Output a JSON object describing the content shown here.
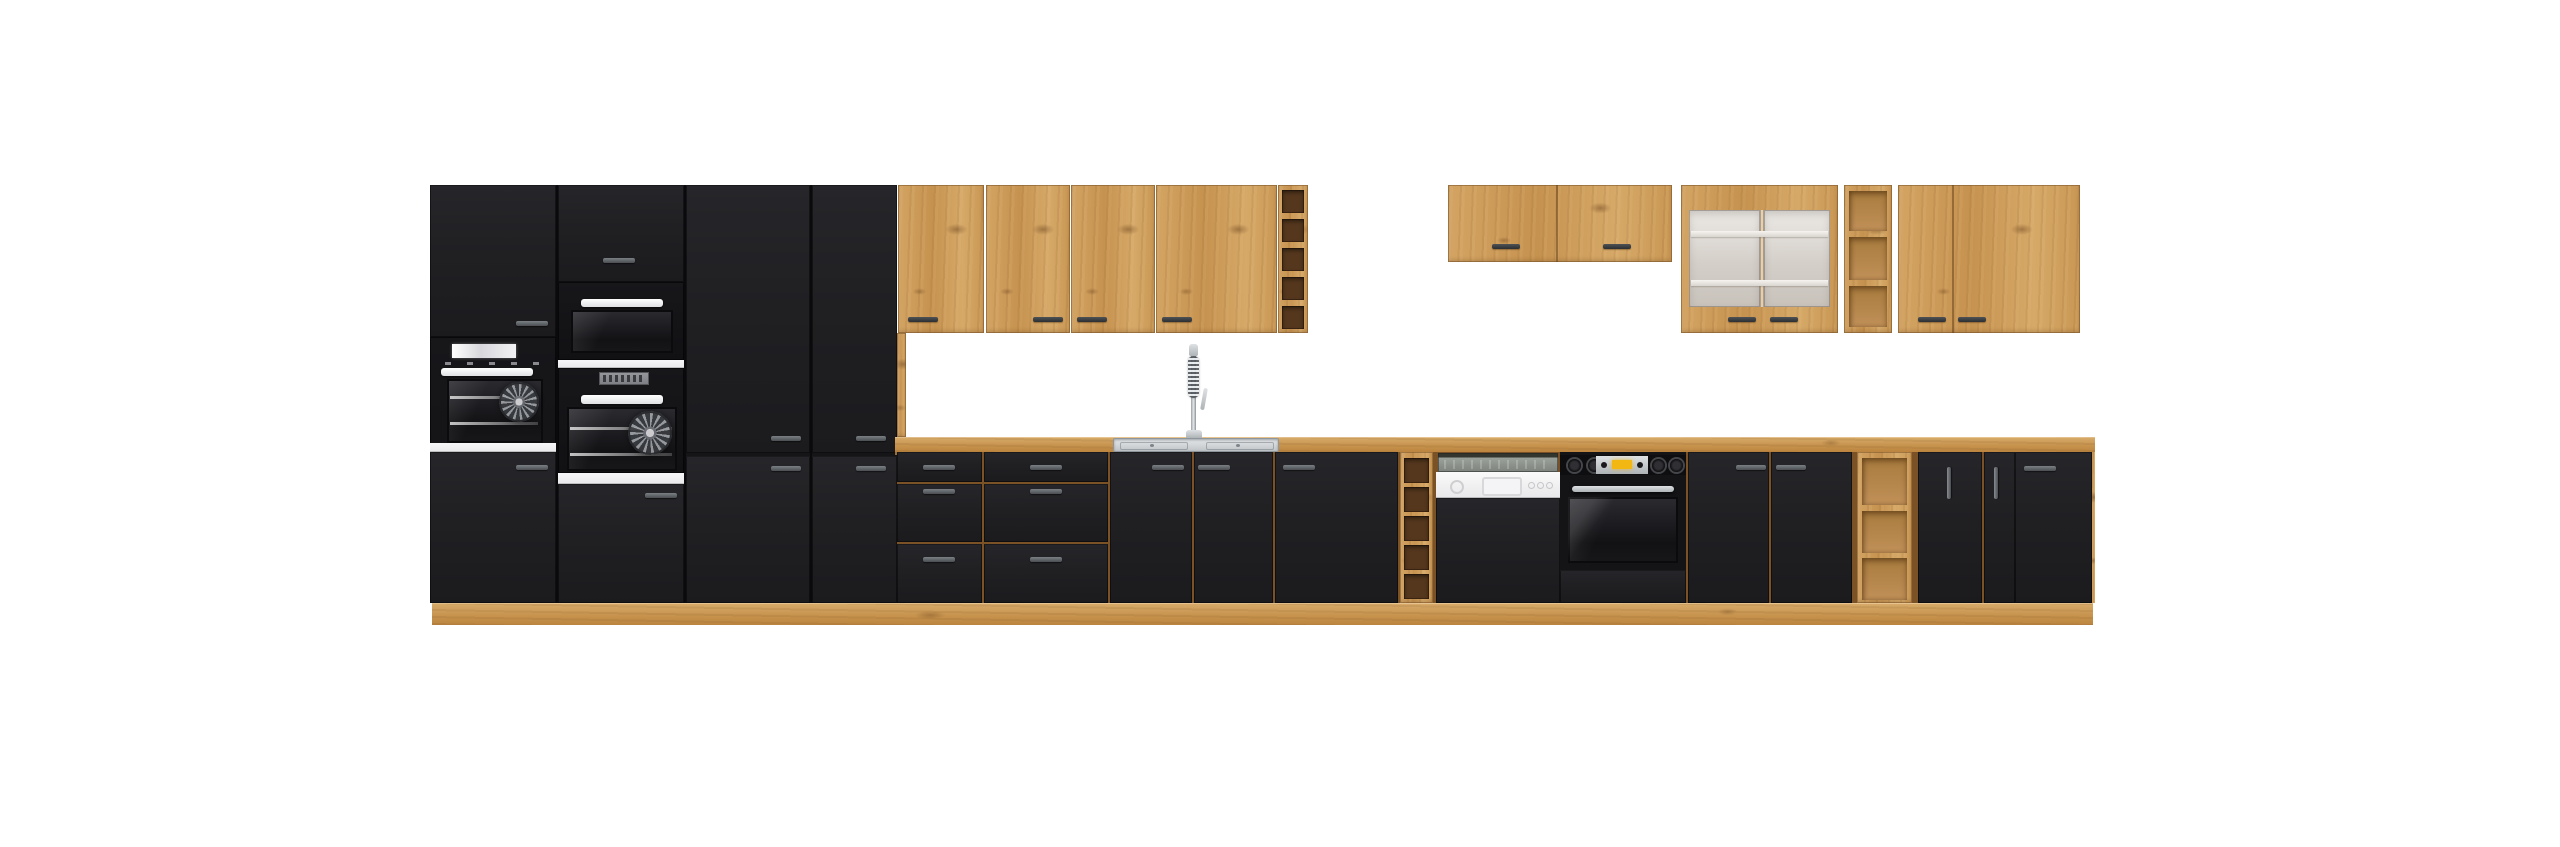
{
  "meta": {
    "type": "product-render",
    "subject": "modular kitchen furniture set, matte black fronts with artisan oak carcass",
    "background": "#ffffff",
    "visible_text": "none"
  },
  "palette": {
    "oak_front": "#cf9f5e",
    "oak_worktop": "#c6924c",
    "oak_plinth": "#c3914e",
    "oak_seam": "#7a5226",
    "black_front": "#202023",
    "appliance_black": "#141417",
    "white_carcass_strip": "#f2f2f4",
    "handle_on_black": "#6a6e72",
    "handle_on_wood": "#3f4347",
    "wine_rack_interior": "#54371d",
    "open_shelf_interior": "#b88845",
    "frosted_glass": "#ddd8d2",
    "steel": "#cfd2d4",
    "oven_display_amber": "#f2b713",
    "dishwasher_panel": "#f3f3f3"
  },
  "scene": {
    "left_tall_section": {
      "units": [
        {
          "name": "tall oven housing A",
          "fronts": [
            "plain upper door",
            "built-in oven with white display and glass door",
            "white carcass strip",
            "plain lower door"
          ]
        },
        {
          "name": "tall oven housing B",
          "fronts": [
            "plain upper door",
            "compact oven / microwave",
            "white carcass strip",
            "built-in fan oven with segment display",
            "white carcass strip",
            "plain lower door"
          ]
        },
        {
          "name": "tall cabinet C",
          "fronts": [
            "upper door",
            "lower door"
          ]
        },
        {
          "name": "tall cabinet D",
          "fronts": [
            "upper door",
            "lower door"
          ]
        }
      ]
    },
    "left_wall_run": {
      "doors": [
        "single door",
        "pair door left",
        "pair door right",
        "wide single door"
      ],
      "end_unit": "wine rack with 5 cubbies"
    },
    "right_wall_run": {
      "units": [
        "short two-door cabinet",
        "frosted glass display cabinet with interior shelves",
        "open shelf unit with 3 cubbies",
        "two-door cabinet"
      ]
    },
    "base_run": {
      "units": [
        "3-drawer unit narrow",
        "3-drawer unit wide",
        "two-door sink cabinet",
        "wide single-door cabinet",
        "wine rack with 5 cubbies",
        "semi-integrated dishwasher",
        "built-in oven housing",
        "two-door cabinet",
        "open shelf unit with 3 cubbies",
        "door with vertical handle",
        "narrow door with vertical handle",
        "wide door with horizontal handle"
      ]
    },
    "worktop": {
      "material": "oak",
      "sink": "inset stainless-steel sink",
      "faucet": "chrome spring pull-down mixer tap"
    },
    "appliances": [
      "built-in oven with white display (tall housing A)",
      "compact oven and built-in fan oven (tall housing B)",
      "semi-integrated dishwasher with white control band",
      "under-counter built-in oven with knobs and amber display"
    ]
  }
}
